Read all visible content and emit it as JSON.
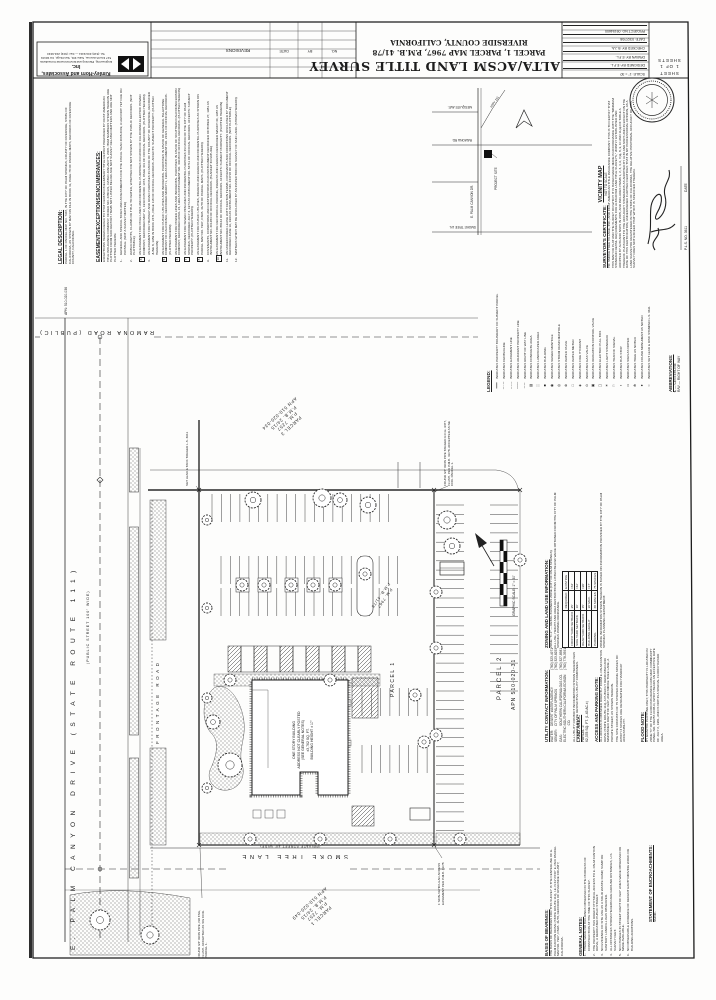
{
  "title_block": {
    "firm": {
      "name": "Kimley-Horn and Associates, Inc.",
      "tagline": "Engineering, Planning and Environmental Consultants",
      "address": "517 Fourth Avenue, Suite 301, San Diego, CA 92101",
      "phone": "Tel. (619) 234-9411 — Fax: (619) 234-9433"
    },
    "revisions": {
      "title": "REVISIONS",
      "date": "DATE",
      "by": "BY",
      "no": "NO."
    },
    "title": {
      "line1": "ALTA/ACSM LAND TITLE SURVEY",
      "line2": "PARCEL 1, PARCEL MAP 7967, P.M.B. 41/78",
      "line3": "RIVERSIDE COUNTY, CALIFORNIA"
    },
    "info_rows": [
      "SCALE: 1\" = 30'",
      "DESIGNED BY: E.F.L.",
      "DRAWN BY: E.F.L.",
      "CHECKED BY: B.J.A.",
      "DATE: 03/27/08",
      "PROJECT NO. 09154600"
    ],
    "sheet": {
      "w1": "SHEET",
      "w2": "1 OF 1",
      "w3": "SHEETS"
    }
  },
  "left_notes": {
    "legal": {
      "heading": "LEGAL DESCRIPTION:",
      "body": "PARCEL 1 OF PARCEL MAP NO. 7967, IN THE CITY OF PALM SPRINGS, COUNTY OF RIVERSIDE, STATE OF CALIFORNIA, AS SHOWN BY MAP ON FILE IN BOOK 41, PAGE 78 OF PARCEL MAPS, RECORDS OF RIVERSIDE COUNTY, CALIFORNIA.",
      "apn": "APN: 510-020-036"
    },
    "easements": {
      "heading": "EASEMENTS/EXCEPTIONS/ENCUMBRANCES:",
      "intro": "EXCEPTIONS HEREIN REFER TO THAT CERTAIN PRELIMINARY TITLE REPORT PREPARED BY FIRST AMERICAN TITLE INSURANCE COMPANY, ORDER NO. 2280121, DATED JANUARY 5, 2008. ITEM NUMBERS SHOWN HEREON ARE PLOTTED FROM SAID REPORT. ITEMS NOT LISTED BELOW ARE NOT SURVEY RELATED MATTERS AND ARE NOT PLOTTED HEREON.",
      "items": [
        {
          "n": "1.",
          "boxed": false,
          "text": "GENERAL AND SPECIAL TAXES AND ASSESSMENTS FOR THE FISCAL YEAR 2008-2009, A LIEN NOT YET DUE OR PAYABLE. (NOT A SURVEY MATTER)"
        },
        {
          "n": "2.",
          "boxed": false,
          "text": "WATER RIGHTS, CLAIMS OR TITLE TO WATER, WHETHER OR NOT SHOWN BY THE PUBLIC RECORDS. (NOT PLOTTABLE)"
        },
        {
          "n": "3",
          "boxed": true,
          "text": "AN EASEMENT FOR POLE LINES AND INCIDENTAL PURPOSES IN FAVOR OF CALIFORNIA ELECTRIC POWER COMPANY, RECORDED MAY 12, 1949 IN BOOK 1073, PAGE 401 OF OFFICIAL RECORDS. (PLOTTED HEREON)"
        },
        {
          "n": "4.",
          "boxed": false,
          "text": "AN EASEMENT FOR HIGHWAY AND ROAD PURPOSES IN FAVOR OF THE COUNTY OF RIVERSIDE, RECORDED JUNE 8, 1959 IN BOOK 2471, PAGE 118 OF OFFICIAL RECORDS. AFFECTS: SUBJECT PROPERTY. (PLOTTED HEREON)"
        },
        {
          "n": "5",
          "boxed": true,
          "text": "AN EASEMENT FOR PUBLIC UTILITIES AND INCIDENTAL PURPOSES IN FAVOR OF GENERAL TELEPHONE COMPANY OF CALIFORNIA, RECORDED MARCH 1, 1966 AS INSTRUMENT NO. 22421 OF OFFICIAL RECORDS. (PLOTTED HEREON)"
        },
        {
          "n": "6",
          "boxed": true,
          "text": "AN EASEMENT FOR POWER LINES AND INCIDENTAL PURPOSES IN FAVOR OF SOUTHERN CALIFORNIA EDISON COMPANY, RECORDED APRIL 24, 1969 AS INSTRUMENT NO. 40648 OF OFFICIAL RECORDS. (PLOTTED HEREON)"
        },
        {
          "n": "7",
          "boxed": true,
          "text": "AN EASEMENT FOR SEWER PIPELINES AND INCIDENTAL PURPOSES IN FAVOR OF THE CITY OF PALM SPRINGS, RECORDED JULY 3, 1974 AS INSTRUMENT NO. 84711 OF OFFICIAL RECORDS. AFFECTS: SUBJECT PROPERTY. (PLOTTED HEREON)"
        },
        {
          "n": "8",
          "boxed": true,
          "text": "AN EASEMENT FOR PUBLIC UTILITIES, INGRESS AND EGRESS AND INCIDENTAL PURPOSES AS SHOWN ON PARCEL MAP NO. 7967, P.M.B. 41/78 OF PARCEL MAPS. (PLOTTED HEREON)"
        },
        {
          "n": "9.",
          "boxed": false,
          "text": "COVENANTS, CONDITIONS AND RESTRICTIONS IN AN INSTRUMENT RECORDED OCTOBER 27, 1981 AS INSTRUMENT NO. 201284 OF OFFICIAL RECORDS. (BLANKET IN NATURE)"
        },
        {
          "n": "10",
          "boxed": true,
          "text": "AN EASEMENT FOR RECIPROCAL PARKING, INGRESS AND EGRESS RECORDED MARCH 30, 1987 AS INSTRUMENT NO. 88164 OF OFFICIAL RECORDS. AFFECTS: SUBJECT PROPERTY. (PLOTTED HEREON)"
        },
        {
          "n": "11.",
          "boxed": false,
          "text": "AN UNRECORDED LEASE WITH CERTAIN TERMS, COVENANTS AND CONDITIONS DISCLOSED BY DOCUMENT RECORDED JUNE 16, 1994 AS INSTRUMENT NO. 244718 OF OFFICIAL RECORDS. (NOT PLOTTABLE)"
        },
        {
          "n": "12.",
          "boxed": false,
          "text": "MATTERS WHICH MAY BE DISCLOSED BY AN INSPECTION OR SURVEY OF SAID LAND. (SHOWN HEREON)"
        }
      ]
    }
  },
  "vicinity": {
    "heading": "VICINITY MAP",
    "scale_note": "NOT TO SCALE",
    "site_label": "PROJECT SITE",
    "streets": {
      "top": "MESQUITE AVE.",
      "mid": "RAMONA RD.",
      "bottom": "SMOKE TREE LN.",
      "vertical": "E. PALM CANYON DR.",
      "hwy": "HWY 111"
    }
  },
  "certificate": {
    "heading": "SURVEYOR'S CERTIFICATE:",
    "body": "TO: SMOKE TREE VILLAGE, INC.; AND FIRST AMERICAN TITLE INSURANCE COMPANY: THIS IS TO CERTIFY THAT THIS MAP OR PLAT AND THE SURVEY ON WHICH IT IS BASED WERE MADE IN ACCORDANCE WITH THE \"MINIMUM STANDARD DETAIL REQUIREMENTS FOR ALTA/ACSM LAND TITLE SURVEYS,\" JOINTLY ESTABLISHED AND ADOPTED BY ALTA AND NSPS IN 2005, AND INCLUDES ITEMS 1, 2, 3, 4, 6, 7(a), 8, 9, 10 AND 11(a) OF TABLE A THEREOF. PURSUANT TO THE ACCURACY STANDARDS AS ADOPTED BY ALTA AND NSPS AND IN EFFECT ON THE DATE OF THIS CERTIFICATION, UNDERSIGNED FURTHER CERTIFIES THAT IN MY PROFESSIONAL OPINION, AS A LAND SURVEYOR REGISTERED IN THE STATE OF CALIFORNIA, THE RELATIVE POSITIONAL ACCURACY OF THIS SURVEY DOES NOT EXCEED THAT WHICH IS SPECIFIED THEREIN.",
    "sig_license": "P.L.S. NO. 3611",
    "sig_date_label": "DATE"
  },
  "legend": {
    "heading": "LEGEND:",
    "items": [
      {
        "sym": "━━━",
        "label": "INDICATES PROPERTY BOUNDARY OF SUBJECT PARCEL"
      },
      {
        "sym": "─ · ─",
        "label": "INDICATES CENTERLINE"
      },
      {
        "sym": "– – –",
        "label": "INDICATES EASEMENT LINE"
      },
      {
        "sym": "───",
        "label": "INDICATES ADJACENT PROPERTY LINE"
      },
      {
        "sym": "─ ─",
        "label": "INDICATES RIGHT OF WAY LINE"
      },
      {
        "sym": "▨",
        "label": "INDICATES CONCRETE AREA"
      },
      {
        "sym": "░",
        "label": "INDICATES LANDSCAPED AREA"
      },
      {
        "sym": "■",
        "label": "INDICATES BUILDING"
      },
      {
        "sym": "◉",
        "label": "INDICATES SEWER MANHOLE"
      },
      {
        "sym": "◎",
        "label": "INDICATES STORM DRAIN MANHOLE"
      },
      {
        "sym": "⊗",
        "label": "INDICATES WATER VALVE"
      },
      {
        "sym": "□",
        "label": "INDICATES WATER METER"
      },
      {
        "sym": "◈",
        "label": "INDICATES FIRE HYDRANT"
      },
      {
        "sym": "⊙",
        "label": "INDICATES GAS VALVE"
      },
      {
        "sym": "▣",
        "label": "INDICATES IRRIGATION CONTROL VALVE"
      },
      {
        "sym": "▢",
        "label": "INDICATES ELECTRIC PULL BOX"
      },
      {
        "sym": "☀",
        "label": "INDICATES LIGHT STANDARD"
      },
      {
        "sym": "⚐",
        "label": "INDICATES TRAFFIC SIGNAL"
      },
      {
        "sym": "▪",
        "label": "INDICATES BUS STOP"
      },
      {
        "sym": "▭",
        "label": "INDICATES SIGN AS NOTED"
      },
      {
        "sym": "✻",
        "label": "INDICATES TREE AS NOTED"
      },
      {
        "sym": "●",
        "label": "INDICATES FOUND MONUMENT AS NOTED"
      },
      {
        "sym": "○",
        "label": "INDICATES SET LEAD & DISC STAMPED L.S. 3611"
      }
    ]
  },
  "abbreviations": {
    "heading": "ABBREVIATIONS:",
    "items": [
      "℄ — CENTERLINE",
      "R/W — RIGHT OF WAY"
    ]
  },
  "zoning": {
    "heading": "ZONING AND LAND USE INFORMATION:",
    "zone_line": "ZONE: \"C-1\" — RETAIL BUSINESS ZONE (CITY OF PALM SPRINGS)",
    "source_line": "ALL USE, HEIGHT AND AREA RESTRICTIONS LISTED BELOW WERE OBTAINED FROM THE CITY OF PALM SPRINGS ZONING ORDINANCE.",
    "table": {
      "headers": [
        "",
        "REQUIRED",
        "EXISTING"
      ],
      "rows": [
        [
          "FRONT YARD SETBACK",
          "25'",
          "±64'"
        ],
        [
          "SIDE YARD SETBACK",
          "10'",
          "±42'"
        ],
        [
          "REAR YARD SETBACK",
          "15'",
          "±20'"
        ],
        [
          "BUILDING HEIGHT",
          "30' MAX.",
          "±17'"
        ],
        [
          "PARKING",
          "68 SPACES",
          "75 SPACES"
        ]
      ]
    },
    "note": "ZONING INFORMATION SHOWN HEREON IS BASED ON INFORMATION PROVIDED BY THE CITY OF PALM SPRINGS PLANNING DEPARTMENT."
  },
  "utilities": {
    "heading": "UTILITY CONTACT INFORMATION:",
    "rows": [
      {
        "label": "WATER:",
        "name": "DESERT WATER AGENCY",
        "phone": "(760) 323-4971"
      },
      {
        "label": "SEWER:",
        "name": "CITY OF PALM SPRINGS",
        "phone": "(760) 323-8253"
      },
      {
        "label": "GAS:",
        "name": "SOUTHERN CALIFORNIA GAS CO.",
        "phone": "(760) 327-8581"
      },
      {
        "label": "ELECTRIC:",
        "name": "SOUTHERN CALIFORNIA EDISON CO.",
        "phone": "(760) 778-3591"
      }
    ],
    "note": "ALL UTILITY CONTACT INFORMATION SHOWN HEREON WAS PROVIDED BY THE RESPECTIVE UTILITY COMPANIES."
  },
  "land_area": {
    "heading": "LAND AREA:",
    "parcel": "PARCEL 1:",
    "area": "62,378 SQ. FT. (1.43 AC.±)"
  },
  "access_note": {
    "heading": "ACCESS AND PARKING NOTE:",
    "p1": "ALL ACCESS IS OBTAINED DIRECTLY FROM E. PALM CANYON DRIVE (STATE ROUTE 111), A PUBLICLY DEDICATED AND MAINTAINED RIGHT OF WAY, AND SMOKE TREE LANE, A PRIVATE STREET, AS SHOWN HEREON.",
    "p2": "THE SITE CONSISTS OF 75 STRIPED PARKING SPACES OF WHICH 3 SPACES ARE DESIGNATED FOR HANDICAP ACCESSIBILITY."
  },
  "flood_note": {
    "heading": "FLOOD NOTE:",
    "body": "BY GRAPHIC PLOTTING ONLY, THIS PROPERTY IS LOCATED IN ZONE \"C\" OF THE FLOOD INSURANCE RATE MAP, COMMUNITY PANEL NO. 060257-0008-D, WHICH BEARS AN EFFECTIVE DATE OF JULY 2, 1981, AND IS NOT IN A SPECIAL FLOOD HAZARD AREA."
  },
  "basis": {
    "heading": "BASIS OF BEARINGS:",
    "body": "THE BASIS OF BEARINGS FOR THIS SURVEY IS THE CENTERLINE OF E. PALM CANYON DRIVE (STATE ROUTE 111), I.E. N 61°23'40\" E, PER PARCEL MAP NO. 7967, P.M.B. 41/78, RECORDS OF RIVERSIDE COUNTY, CALIFORNIA."
  },
  "general_notes": {
    "heading": "GENERAL NOTES:",
    "items": [
      "THERE WERE NO BUILDINGS OBSERVED IN THE PROCESS OF CONSTRUCTION AT THE TIME OF THIS SURVEY.",
      "THE PROPERTY HAS DIRECT PHYSICAL ACCESS TO E. PALM CANYON DRIVE, A DEDICATED PUBLIC STREET.",
      "NO EVIDENCE OF SITE USE AS A SOLID WASTE DUMP, SUMP OR SANITARY LANDFILL WAS OBSERVED.",
      "ALL DISTANCES SHOWN HEREON ARE GROUND DISTANCES, U.S. SURVEY FEET.",
      "NO CHANGES IN STREET RIGHT OF WAY LINES WERE OBSERVED OR MADE AVAILABLE.",
      "NO OBSERVABLE EVIDENCE OF RECENT EARTH MOVING WORK OR BUILDING ADDITIONS."
    ]
  },
  "encroachments": {
    "heading": "STATEMENT OF ENCROACHMENTS:",
    "body": "NONE."
  },
  "plan": {
    "roads": {
      "ramona": "RAMONA ROAD (PUBLIC)",
      "palm": "E. PALM CANYON DRIVE (STATE ROUTE 111)",
      "palm_sub": "(PUBLIC STREET 100' WIDE)",
      "frontage": "FRONTAGE ROAD",
      "smoke": "SMOKE TREE LANE",
      "smoke_sub": "(PRIVATE STREET 40' WIDE)"
    },
    "parcels": {
      "p3": [
        "PARCEL 3",
        "P.M. 7257",
        "P.M.B. 24/15",
        "APN 510-020-034"
      ],
      "p1s": [
        "PARCEL 1",
        "P.M. 7257",
        "P.M.B. 24/15",
        "APN 510-020-049"
      ],
      "p2": "PARCEL 2",
      "p2_apn": "APN 510-020-31",
      "p1": "PARCEL 1",
      "pm": "P.M. 7967",
      "pmb": "P.M.B. 41/78"
    },
    "building": {
      "lines": [
        "ONE STORY BUILDING",
        "ADDRESS NOT CLEARLY POSTED",
        "(SEE GENERAL NOTES)",
        "±3,762 SQ. FT.",
        "BUILDING HEIGHT ± 17'"
      ]
    },
    "notes": {
      "ne": "FOUND 3/4\" IRON PIPE TAGGED R.C.E. 9377, FLUSH, PER P.M.B. 41/78. ACCEPTED AS NE COR. PARCEL 1.",
      "nw": "SET LEAD & TACK TAGGED L.S. 3611",
      "se": "1' NON-VEHICULAR ACCESS EASEMENT PER P.M.B. 41/78",
      "sw": "FOUND 3/4\" IRON PIPE, NO TAG, FLUSH. ACCEPTED AS SW COR. PARCEL 1."
    },
    "scale_label": "GRAPHIC SCALE: 1\" = 30'"
  }
}
